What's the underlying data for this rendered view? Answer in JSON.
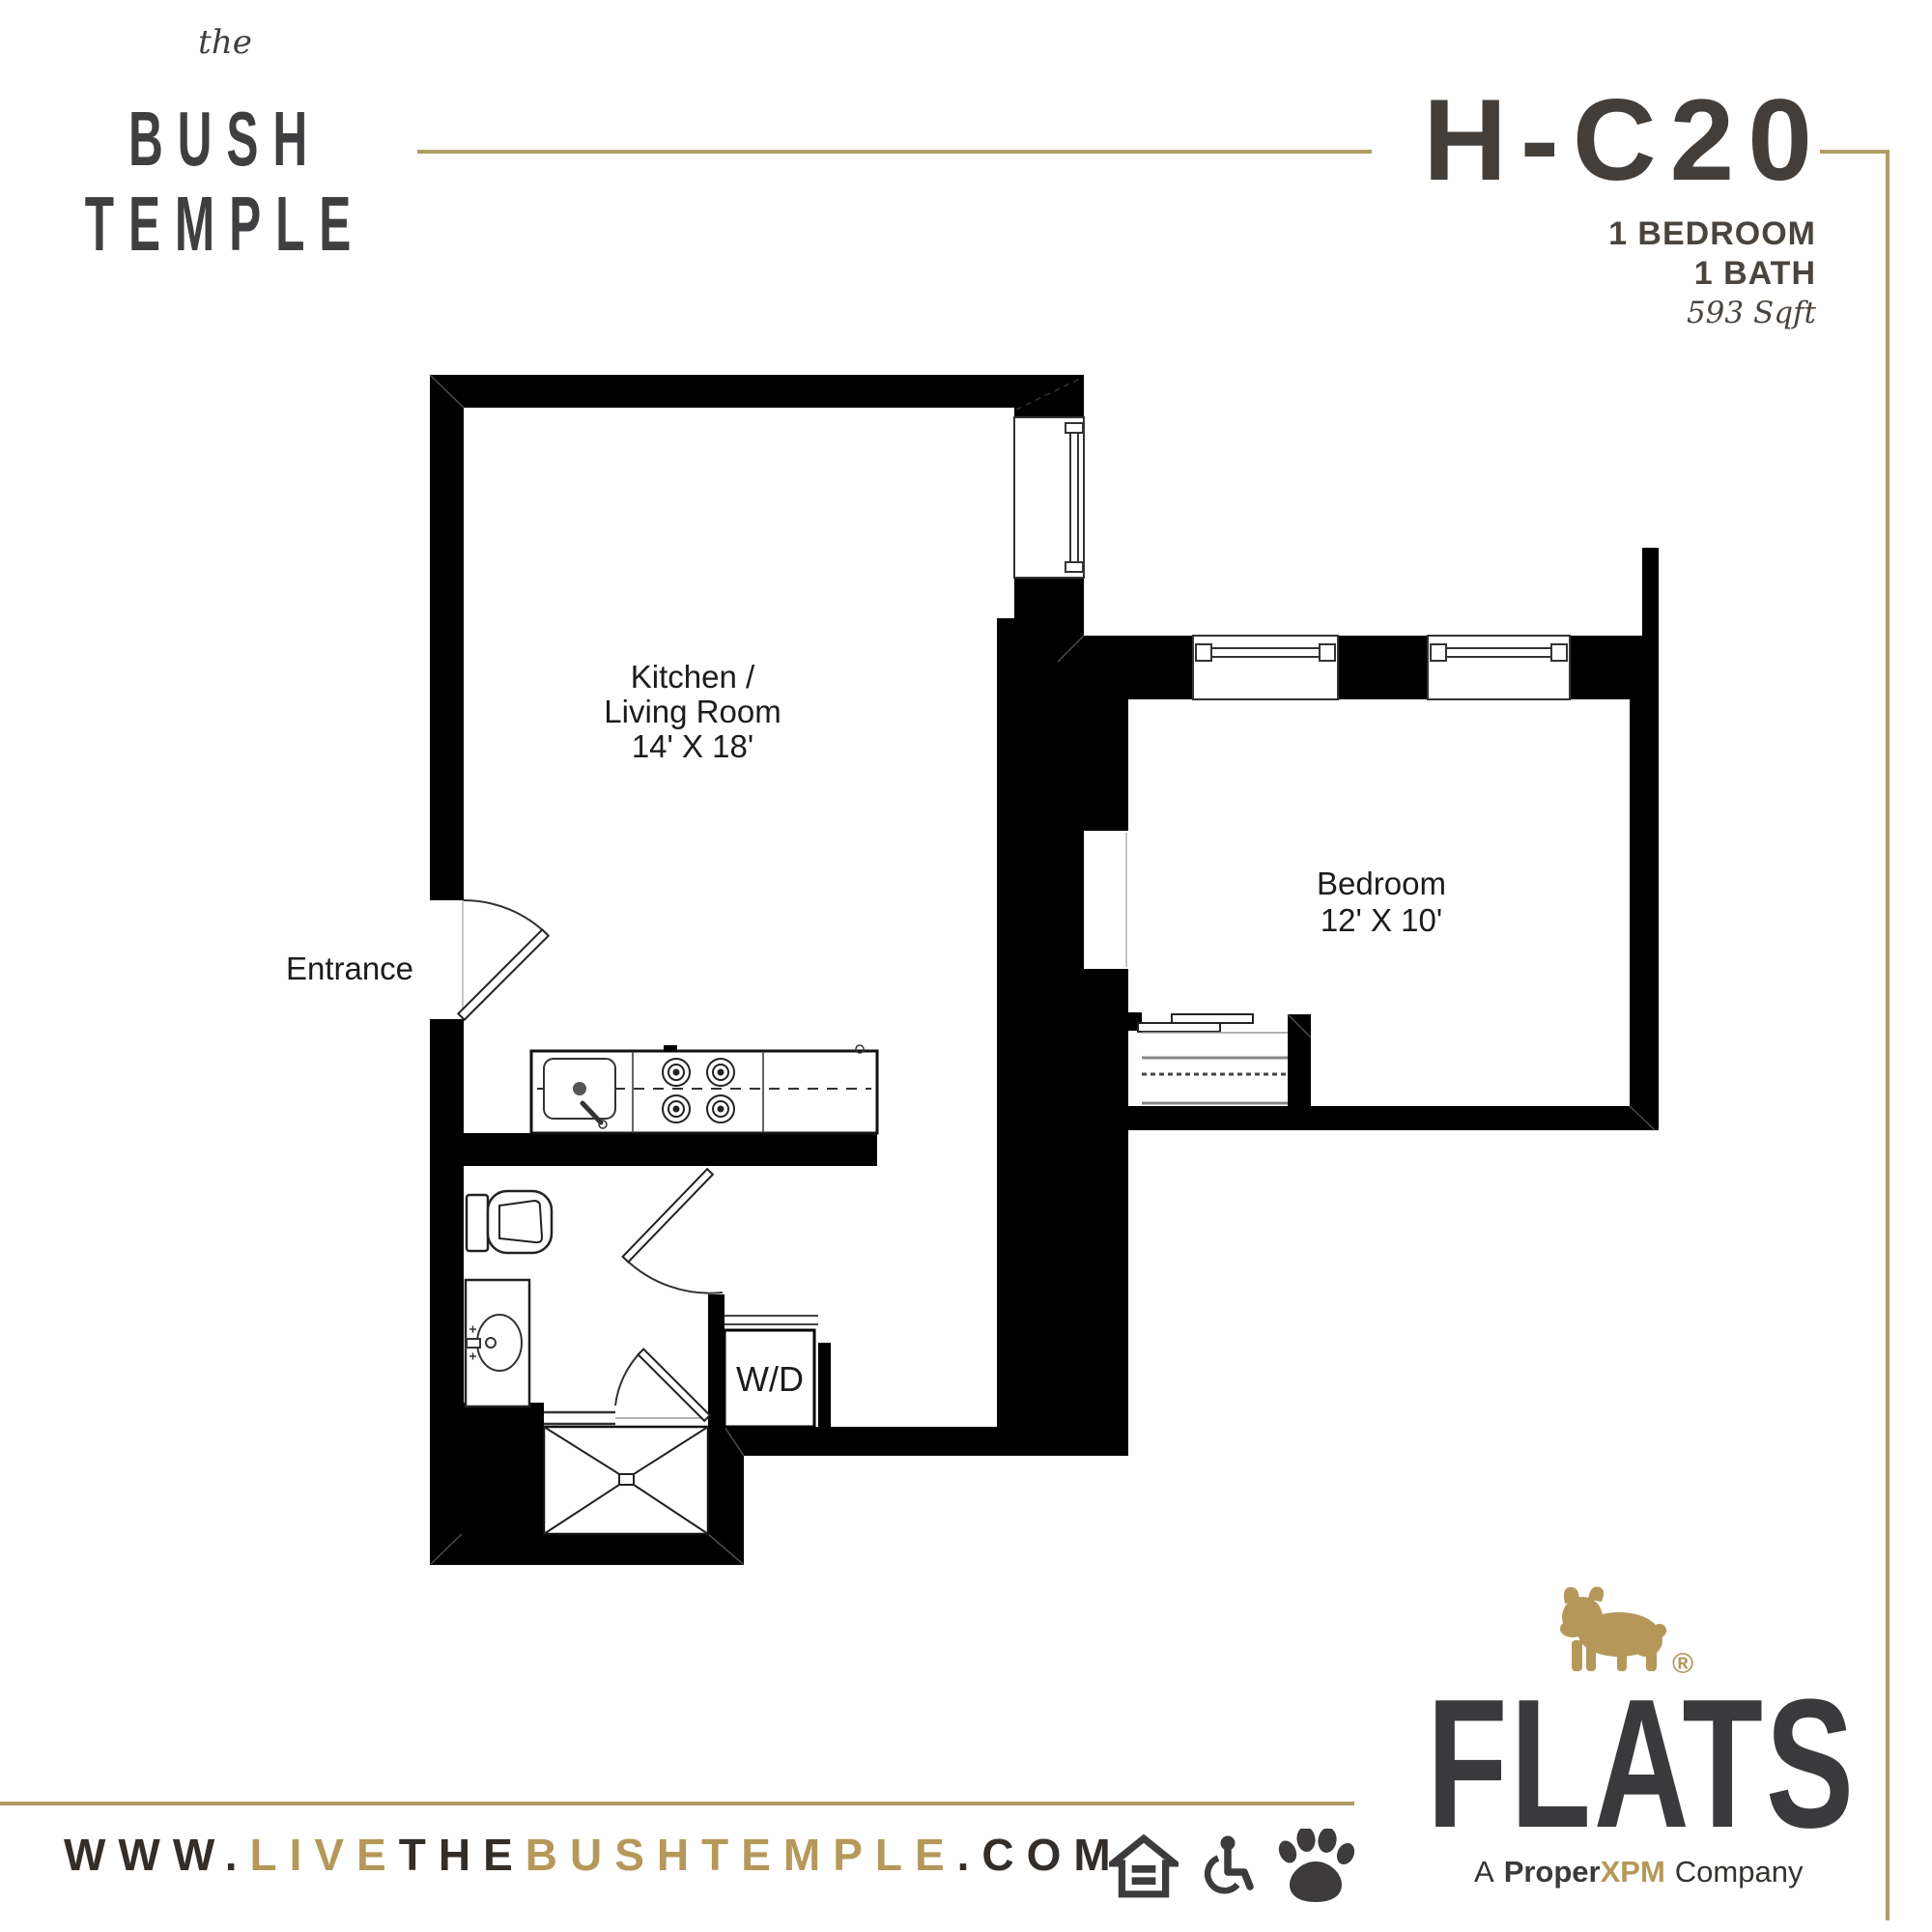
{
  "header": {
    "brand": {
      "prefix": "the",
      "line1": "BUSH",
      "line2": "TEMPLE"
    },
    "unit": {
      "code": "H-C20",
      "bedrooms": "1 BEDROOM",
      "baths": "1 BATH",
      "area": "593 Sqft"
    }
  },
  "floorplan": {
    "kitchen_living": {
      "line1": "Kitchen /",
      "line2": "Living Room",
      "dims": "14' X 18'"
    },
    "bedroom": {
      "name": "Bedroom",
      "dims": "12' X 10'"
    },
    "entrance_label": "Entrance",
    "washer_dryer": "W/D"
  },
  "footer": {
    "website": {
      "www": "WWW.",
      "live": "LIVE",
      "the": "THE",
      "bushtemple": "BUSHTEMPLE",
      "com": ".COM"
    },
    "icons": [
      "equal-housing-icon",
      "accessibility-icon",
      "pet-friendly-icon"
    ],
    "logo": {
      "name": "FLATS",
      "registered": "®",
      "tagline_a": "A",
      "tagline_bold": "Proper",
      "tagline_gold": "XPM",
      "tagline_company": "Company"
    }
  },
  "colors": {
    "gold": "#b09c63",
    "gold_text": "#b5985a",
    "dark": "#3a342e",
    "charcoal": "#3a3a3c"
  }
}
